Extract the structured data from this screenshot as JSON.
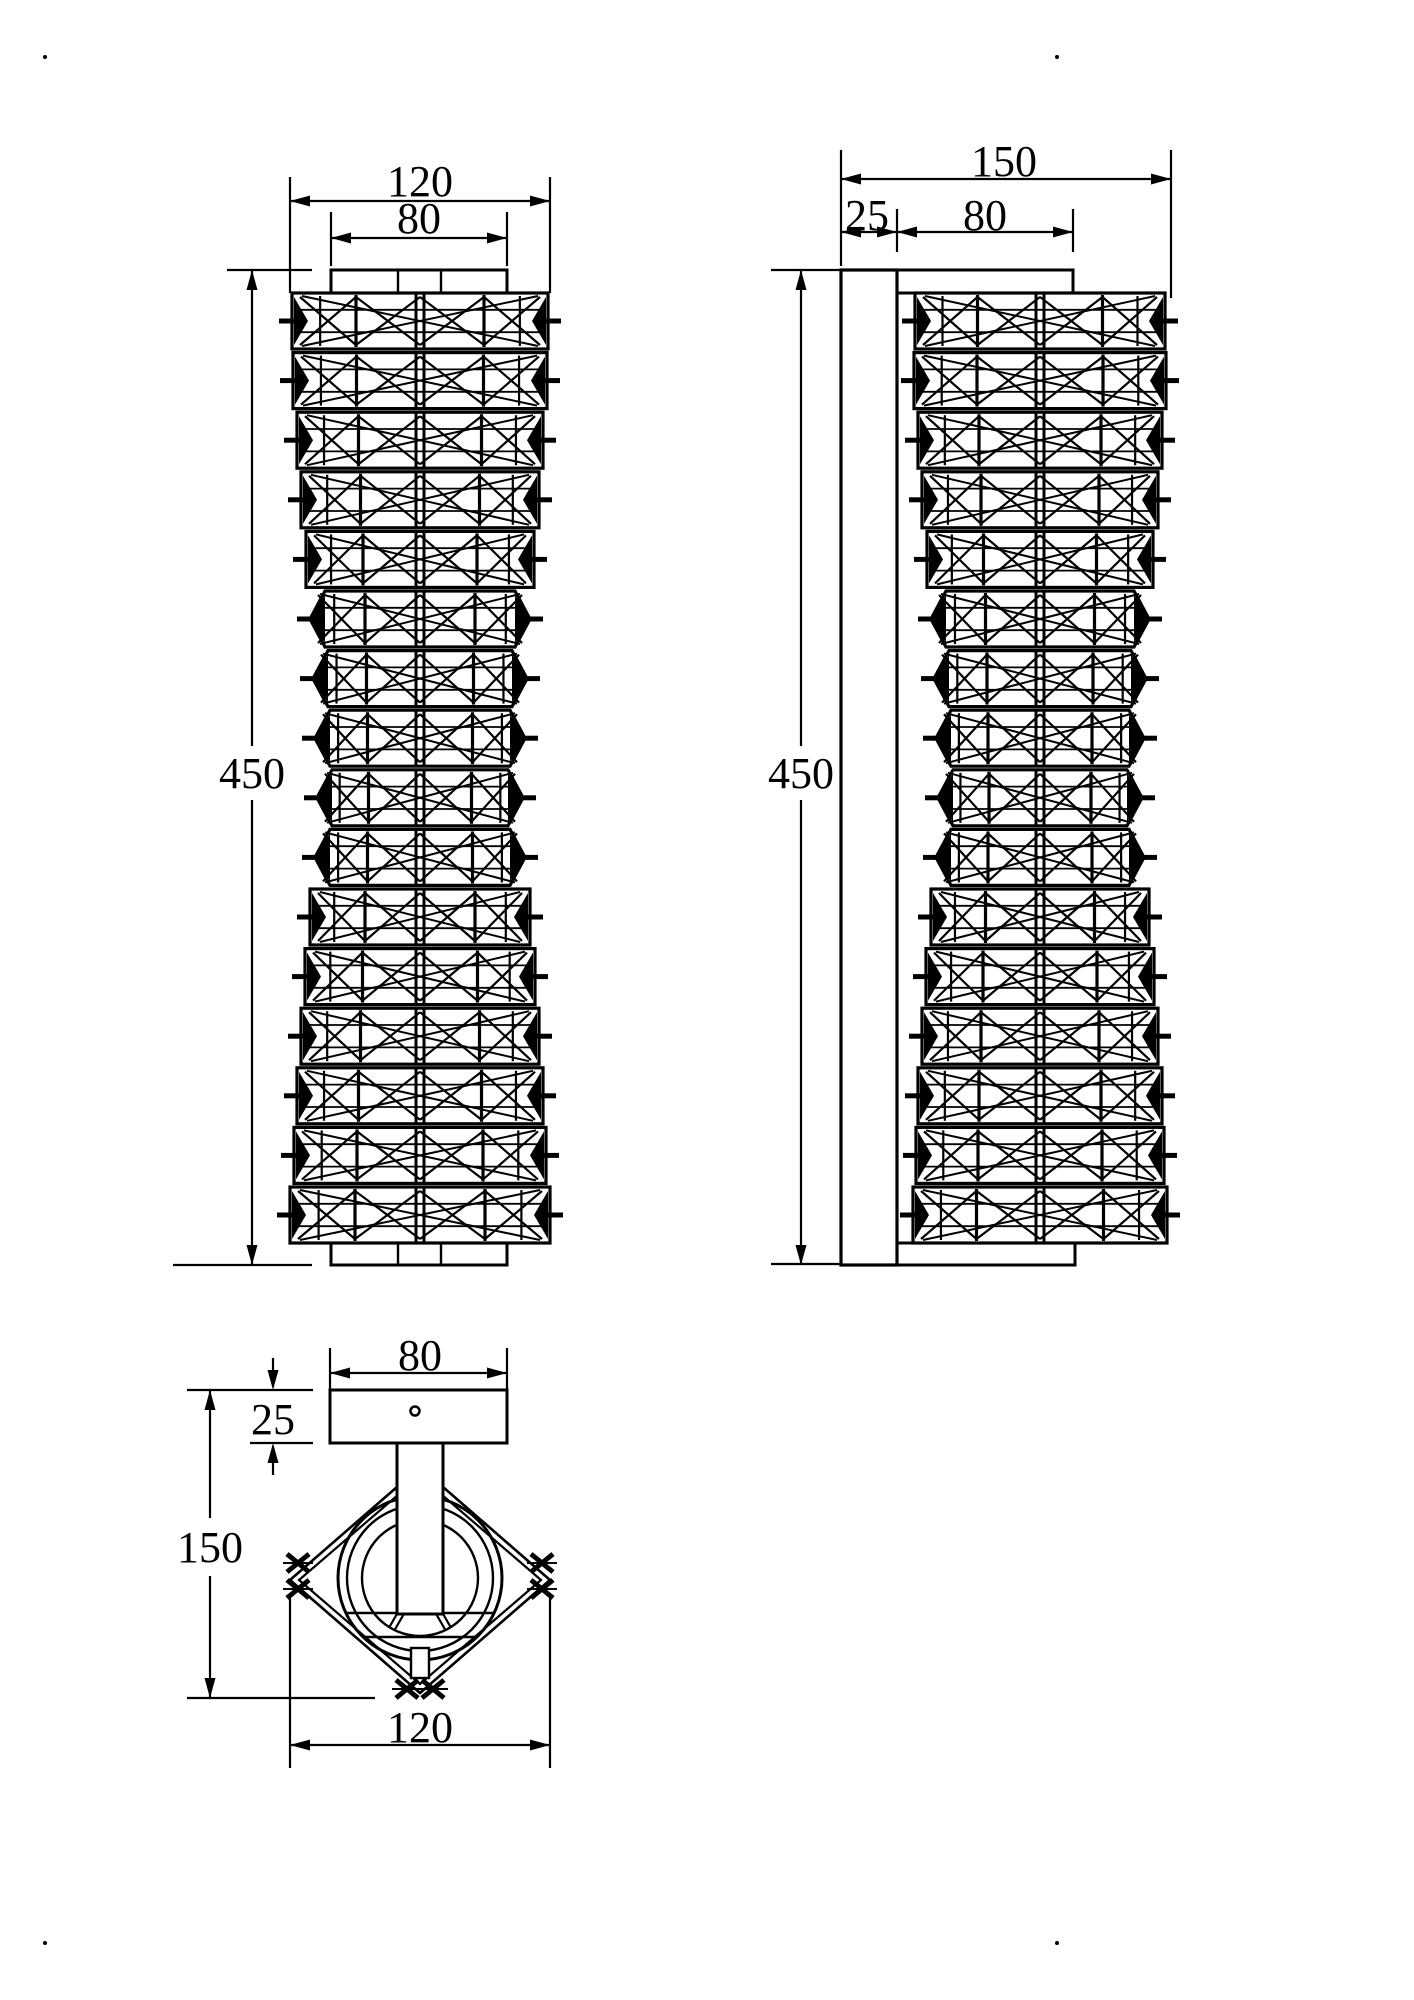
{
  "drawing": {
    "title": "wall-sconce-dimension-drawing",
    "width": 1414,
    "height": 2000,
    "background": "#ffffff",
    "line_color": "#000000",
    "font_size": 44,
    "corner_dots": [
      [
        45,
        57
      ],
      [
        1057,
        57
      ],
      [
        45,
        1943
      ],
      [
        1057,
        1943
      ]
    ],
    "views": {
      "front": {
        "center_x": 420,
        "band_h": 56,
        "band_gap": 3.6,
        "body_top": 293,
        "caps": [
          {
            "x": 331,
            "y": 270,
            "w": 176,
            "h": 23,
            "dividers": [
              398,
              441
            ]
          },
          {
            "x": 331,
            "y": 1243,
            "w": 176,
            "h": 22,
            "dividers": [
              398,
              441
            ]
          }
        ],
        "band_halfwidths": [
          128,
          127,
          123,
          119,
          114,
          110,
          107,
          105,
          103,
          105,
          110,
          115,
          119,
          123,
          126,
          130
        ],
        "band_shapes": [
          "rect",
          "rect",
          "rect",
          "rect",
          "rect",
          "hex",
          "hex",
          "hex",
          "hex",
          "hex",
          "rect",
          "rect",
          "rect",
          "rect",
          "rect",
          "rect"
        ]
      },
      "side": {
        "center_x": 1040,
        "band_h": 56,
        "band_gap": 3.6,
        "body_top": 293,
        "plate": {
          "x": 841,
          "y": 270,
          "w": 56,
          "h": 995
        },
        "caps": [
          {
            "x": 897,
            "y": 270,
            "w": 176,
            "h": 23,
            "dividers": []
          },
          {
            "x": 897,
            "y": 1243,
            "w": 178,
            "h": 22,
            "dividers": []
          }
        ],
        "band_halfwidths": [
          125,
          126,
          122,
          118,
          113,
          109,
          106,
          104,
          102,
          104,
          109,
          114,
          118,
          122,
          124,
          127
        ],
        "band_shapes": [
          "rect",
          "rect",
          "rect",
          "rect",
          "rect",
          "hex",
          "hex",
          "hex",
          "hex",
          "hex",
          "rect",
          "rect",
          "rect",
          "rect",
          "rect",
          "rect"
        ]
      },
      "bottom": {
        "plate": {
          "x": 330,
          "y": 1390,
          "w": 177,
          "h": 53
        },
        "screw_hole": {
          "cx": 415,
          "cy": 1411,
          "r": 4.5
        },
        "stem": {
          "x": 397,
          "y": 1443,
          "w": 46,
          "h": 171
        },
        "diamond": {
          "cx": 420,
          "cy": 1580,
          "rx": 130,
          "ry": 113,
          "inner_offset": 9
        },
        "circle_radii": [
          82,
          73,
          58
        ],
        "chords": [
          {
            "y": 1613,
            "x1": 346,
            "x2": 494
          },
          {
            "y": 1637,
            "x1": 363,
            "x2": 477
          }
        ],
        "spoke_angles_deg": [
          60,
          120
        ],
        "spoke_r_inner": 24,
        "spoke_r_outer": 57,
        "small_rect": {
          "x": 411,
          "y": 1648,
          "w": 18,
          "h": 30
        },
        "xmarks": [
          [
            298,
            1563
          ],
          [
            298,
            1589
          ],
          [
            542,
            1563
          ],
          [
            542,
            1589
          ],
          [
            407,
            1689
          ],
          [
            433,
            1689
          ]
        ]
      }
    },
    "dimensions": [
      {
        "id": "front-width-outer",
        "label": "120",
        "type": "h",
        "y": 201,
        "x1": 290,
        "x2": 550,
        "lx": 420,
        "ly": 196,
        "ext": [
          [
            290,
            177,
            290,
            293
          ],
          [
            550,
            177,
            550,
            293
          ]
        ]
      },
      {
        "id": "front-width-inner",
        "label": "80",
        "type": "h",
        "y": 238,
        "x1": 331,
        "x2": 507,
        "lx": 419,
        "ly": 233,
        "ext": [
          [
            331,
            212,
            331,
            266
          ],
          [
            507,
            212,
            507,
            266
          ]
        ]
      },
      {
        "id": "front-height",
        "label": "450",
        "type": "v",
        "x": 252,
        "y1": 270,
        "y2": 1265,
        "lx": 252,
        "ly": 788,
        "gap": [
          746,
          800
        ],
        "ext": [
          [
            227,
            270,
            312,
            270
          ],
          [
            173,
            1265,
            312,
            1265
          ]
        ]
      },
      {
        "id": "side-depth-total",
        "label": "150",
        "type": "h",
        "y": 179,
        "x1": 841,
        "x2": 1171,
        "lx": 1004,
        "ly": 176,
        "ext": [
          [
            841,
            150,
            841,
            266
          ],
          [
            1171,
            150,
            1171,
            298
          ]
        ]
      },
      {
        "id": "side-plate-depth",
        "label": "25",
        "type": "h",
        "y": 232,
        "x1": 841,
        "x2": 897,
        "lx": 867,
        "ly": 230,
        "ext": [
          [
            897,
            209,
            897,
            252
          ]
        ]
      },
      {
        "id": "side-body-offset",
        "label": "80",
        "type": "h",
        "y": 232,
        "x1": 897,
        "x2": 1073,
        "lx": 985,
        "ly": 230,
        "ext": [
          [
            1073,
            209,
            1073,
            252
          ]
        ]
      },
      {
        "id": "side-height",
        "label": "450",
        "type": "v",
        "x": 801,
        "y1": 270,
        "y2": 1265,
        "lx": 801,
        "ly": 788,
        "gap": [
          746,
          800
        ],
        "ext": [
          [
            771,
            270,
            841,
            270
          ],
          [
            771,
            1264,
            841,
            1264
          ]
        ]
      },
      {
        "id": "bottom-plate-width",
        "label": "80",
        "type": "h",
        "y": 1373,
        "x1": 330,
        "x2": 507,
        "lx": 420,
        "ly": 1370,
        "ext": [
          [
            330,
            1348,
            330,
            1392
          ],
          [
            507,
            1348,
            507,
            1392
          ]
        ]
      },
      {
        "id": "bottom-plate-depth",
        "label": "25",
        "type": "v-out",
        "x": 273,
        "y1": 1390,
        "y2": 1443,
        "lx": 273,
        "ly": 1434,
        "ext": [
          [
            187,
            1390,
            313,
            1390
          ],
          [
            250,
            1443,
            313,
            1443
          ]
        ]
      },
      {
        "id": "bottom-depth",
        "label": "150",
        "type": "v",
        "x": 210,
        "y1": 1390,
        "y2": 1698,
        "lx": 210,
        "ly": 1562,
        "gap": [
          1518,
          1576
        ],
        "ext": [
          [
            187,
            1698,
            375,
            1698
          ]
        ]
      },
      {
        "id": "bottom-width",
        "label": "120",
        "type": "h",
        "y": 1745,
        "x1": 290,
        "x2": 550,
        "lx": 420,
        "ly": 1742,
        "ext": [
          [
            290,
            1598,
            290,
            1768
          ],
          [
            550,
            1598,
            550,
            1768
          ]
        ]
      }
    ]
  }
}
